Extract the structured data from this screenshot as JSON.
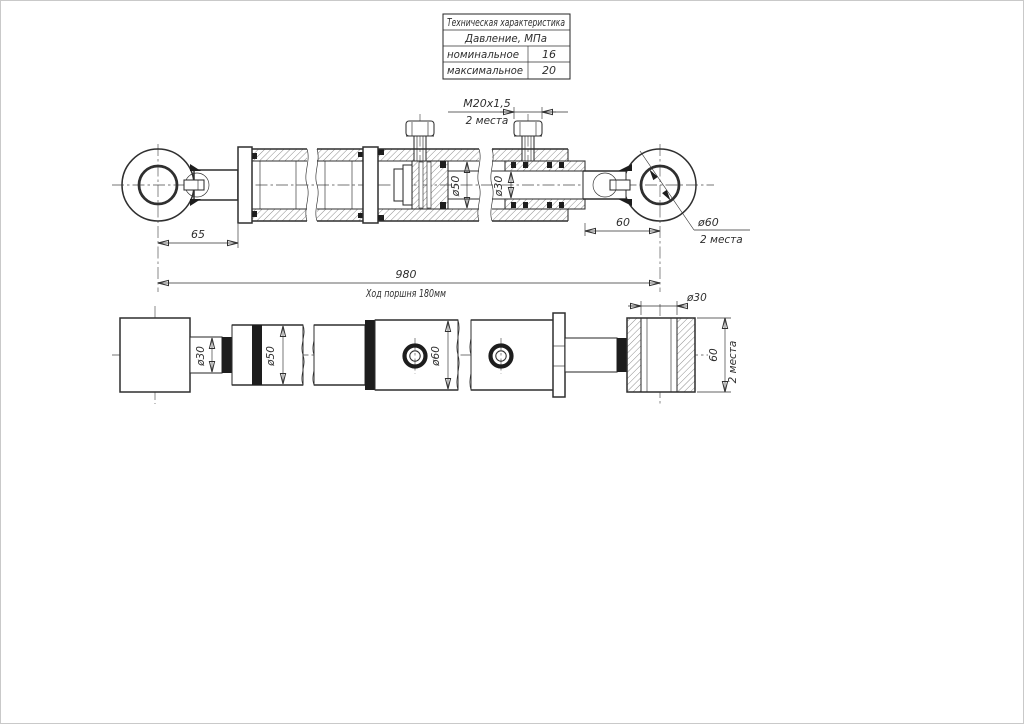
{
  "spec_table": {
    "title": "Техническая характеристика",
    "subtitle": "Давление, МПа",
    "rows": [
      {
        "label": "номинальное",
        "value": "16"
      },
      {
        "label": "максимальное",
        "value": "20"
      }
    ]
  },
  "section_view": {
    "thread_size": "M20x1,5",
    "thread_note": "2 места",
    "dim_eye_left": "65",
    "dim_bore": "ø50",
    "dim_rod": "ø30",
    "dim_rod_end": "60",
    "eye_hole": "ø60",
    "eye_hole_note": "2 места",
    "dim_overall": "980",
    "stroke_note": "Ход поршня 180мм"
  },
  "plan_view": {
    "dim_rod": "ø30",
    "dim_sleeve": "ø50",
    "dim_barrel": "ø60",
    "dim_eye_hole": "ø30",
    "dim_eye_width": "60",
    "eye_width_note": "2 места"
  }
}
